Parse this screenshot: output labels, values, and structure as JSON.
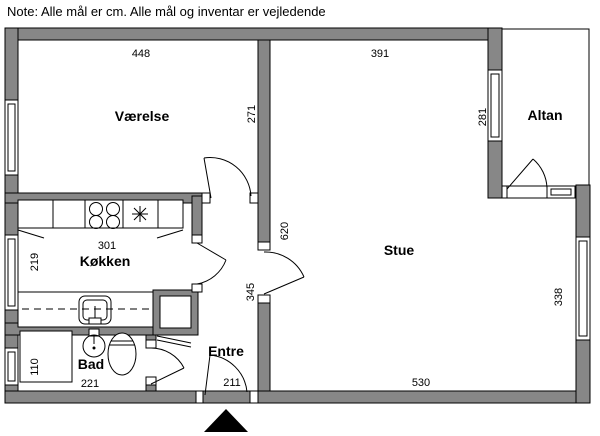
{
  "note": "Note: Alle mål er cm. Alle mål og inventar er vejledende",
  "rooms": {
    "vaerelse": "Værelse",
    "koekken": "Køkken",
    "stue": "Stue",
    "bad": "Bad",
    "entre": "Entre",
    "altan": "Altan"
  },
  "dimensions_cm": {
    "vaerelse_width": "448",
    "vaerelse_depth": "271",
    "stue_top": "391",
    "stue_left": "620",
    "stue_bottom": "530",
    "stue_window": "338",
    "altan_window": "281",
    "entre_wall": "345",
    "koekken_counter": "301",
    "koekken_window": "219",
    "bad_width": "221",
    "bad_window": "110",
    "entre_door": "211"
  },
  "colors": {
    "wall": "#878787",
    "line": "#000000",
    "background": "#ffffff"
  }
}
